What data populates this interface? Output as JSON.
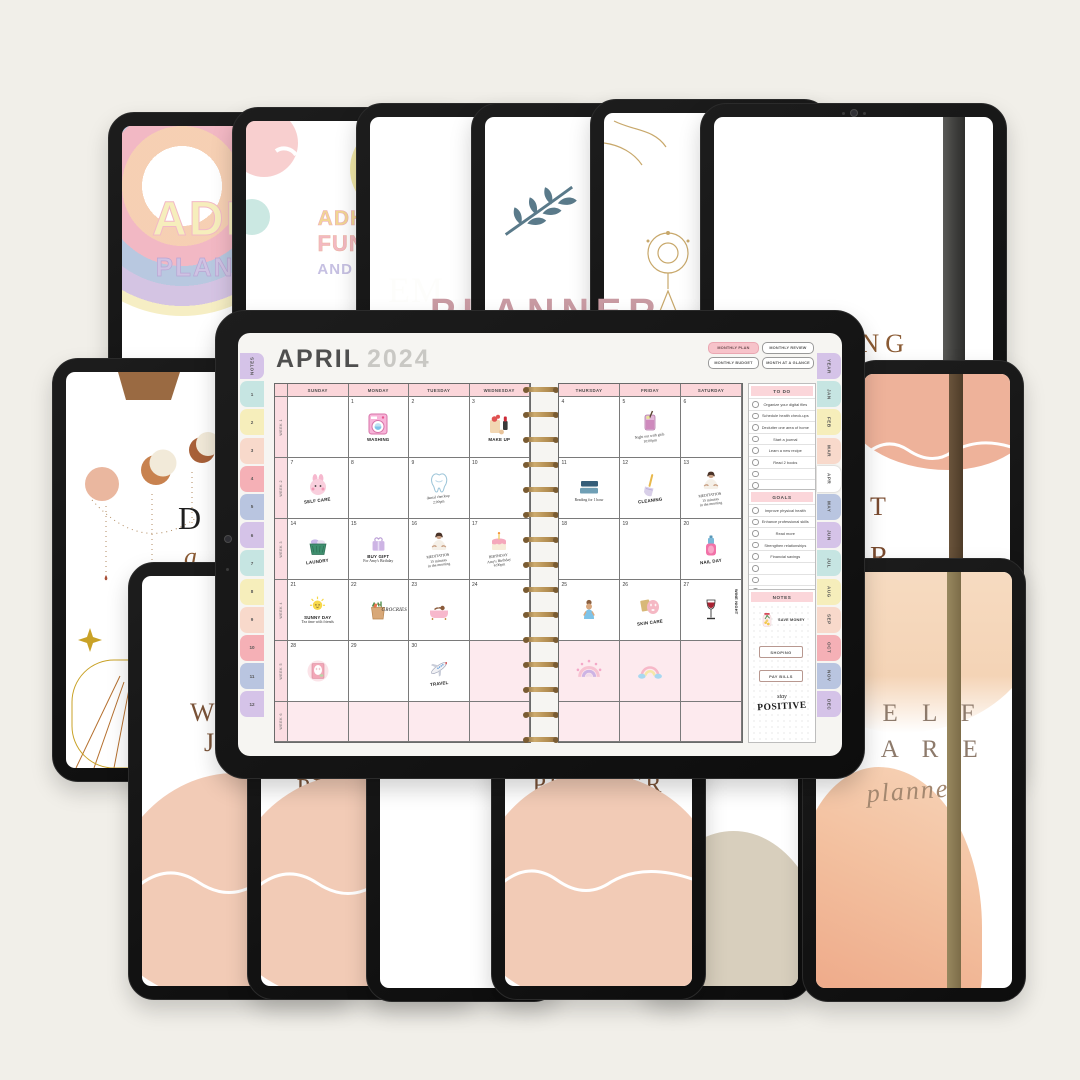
{
  "scene": {
    "background": "#f1efe9"
  },
  "covers": {
    "rainbow_planner": {
      "line1": "ADHD",
      "line2": "PLANNER"
    },
    "smiley_planner": {
      "line1": "ADHD",
      "line2": "FUNC",
      "line3": "AND CO"
    },
    "brown_monogram": {
      "text": "EM"
    },
    "reading_journal": {
      "line1": "READING",
      "line2": "JOURNAL"
    },
    "celestial": {
      "letter": "D",
      "script": "a"
    },
    "peach_strap": {
      "frag1": "T",
      "frag2": "R"
    },
    "hidden_top": {
      "fragment": "PLANNER"
    },
    "bottom_left_journal": {
      "frag1": "W",
      "frag2": "J"
    },
    "bottom_planner_fragment": {
      "text": "PLANNER"
    },
    "self_care": {
      "line1": "S E L F",
      "line2": "C A R E",
      "script": "planner"
    }
  },
  "planner": {
    "title_month": "APRIL",
    "title_year": "2024",
    "view_buttons": [
      {
        "label": "MONTHLY PLAN",
        "active": true
      },
      {
        "label": "MONTHLY REVIEW",
        "active": false
      },
      {
        "label": "MONTHLY BUDGET",
        "active": false
      },
      {
        "label": "MONTH AT A GLANCE",
        "active": false
      }
    ],
    "left_tabs": [
      "NOTES",
      "1",
      "2",
      "3",
      "4",
      "5",
      "6",
      "7",
      "8",
      "9",
      "10",
      "11",
      "12"
    ],
    "right_tabs": [
      "YEAR",
      "JAN",
      "FEB",
      "MAR",
      "APR",
      "MAY",
      "JUN",
      "JUL",
      "AUG",
      "SEP",
      "OCT",
      "NOV",
      "DEC"
    ],
    "active_right_tab": "APR",
    "week_labels": [
      "WEEK 1",
      "WEEK 2",
      "WEEK 3",
      "WEEK 4",
      "WEEK 5",
      "WEEK 6"
    ],
    "day_headers_left": [
      "SUNDAY",
      "MONDAY",
      "TUESDAY",
      "WEDNESDAY"
    ],
    "day_headers_right": [
      "THURSDAY",
      "FRIDAY",
      "SATURDAY"
    ],
    "weeks": [
      {
        "left": [
          {},
          {
            "d": "1",
            "s": "washing-machine",
            "l": "WASHING"
          },
          {
            "d": "2"
          },
          {
            "d": "3",
            "s": "makeup",
            "l": "MAKE UP"
          }
        ],
        "right": [
          {
            "d": "4"
          },
          {
            "d": "5",
            "s": "cocktail",
            "n": "Night out with girls\n10:00pm",
            "tilt": true
          },
          {
            "d": "6"
          }
        ]
      },
      {
        "left": [
          {
            "d": "7",
            "s": "bunny",
            "l": "SELF CARE",
            "tilt": true
          },
          {
            "d": "8"
          },
          {
            "d": "9",
            "s": "tooth",
            "n": "dental checkup\n2:00pm",
            "tilt": true
          },
          {
            "d": "10"
          }
        ],
        "right": [
          {
            "d": "11",
            "s": "books",
            "n": "Reading for 1 hour"
          },
          {
            "d": "12",
            "s": "broom",
            "l": "CLEANING",
            "tilt": true
          },
          {
            "d": "13",
            "s": "meditation",
            "n": "MEDITATION\n15 minutes\nin the morning",
            "tilt": true
          }
        ]
      },
      {
        "left": [
          {
            "d": "14",
            "s": "laundry-basket",
            "l": "LAUNDRY",
            "tilt": true
          },
          {
            "d": "15",
            "s": "gift",
            "l": "BUY GIFT",
            "n": "For Amy's Birthday"
          },
          {
            "d": "16",
            "s": "meditation",
            "n": "MEDITATION\n15 minutes\nin the morning",
            "tilt": true
          },
          {
            "d": "17",
            "s": "cake",
            "n": "BIRTHDAY\nAmy's Birthday\n6:00pm",
            "tilt": true
          }
        ],
        "right": [
          {
            "d": "18"
          },
          {
            "d": "19"
          },
          {
            "d": "20",
            "s": "nail-polish",
            "l": "NAIL DAY",
            "tilt": true
          }
        ]
      },
      {
        "left": [
          {
            "d": "21",
            "s": "sun",
            "l": "SUNNY DAY",
            "n": "Tea time with friends"
          },
          {
            "d": "22",
            "s": "groceries",
            "l": "GROCRIES",
            "side": true
          },
          {
            "d": "23",
            "s": "bathtub"
          },
          {
            "d": "24"
          }
        ],
        "right": [
          {
            "d": "25",
            "s": "woman"
          },
          {
            "d": "26",
            "s": "skincare",
            "l": "SKIN CARE",
            "tilt": true
          },
          {
            "d": "27",
            "s": "wine",
            "l": "WINE NIGHT",
            "vert": true
          }
        ]
      },
      {
        "left": [
          {
            "d": "28",
            "s": "face-mask"
          },
          {
            "d": "29"
          },
          {
            "d": "30",
            "s": "airplane",
            "l": "TRAVEL",
            "tilt": true
          },
          {
            "pink": true
          }
        ],
        "right": [
          {
            "pink": true,
            "s": "rainbow-hearts"
          },
          {
            "pink": true,
            "s": "rainbow-clouds"
          },
          {
            "pink": true
          }
        ]
      },
      {
        "left": [
          {
            "pink": true
          },
          {
            "pink": true
          },
          {
            "pink": true
          },
          {
            "pink": true
          }
        ],
        "right": [
          {
            "pink": true
          },
          {
            "pink": true
          },
          {
            "pink": true
          }
        ]
      }
    ],
    "todo": {
      "title": "TO DO",
      "items": [
        "Organize your digital files",
        "Schedule health check-ups",
        "Declutter one area of home",
        "Start a journal",
        "Learn a new recipe",
        "Read 2 books"
      ],
      "empty_rows": 2
    },
    "goals": {
      "title": "GOALS",
      "items": [
        "Improve physical health",
        "Enhance professional skills",
        "Read more",
        "Strengthen relationships",
        "Financial savings"
      ],
      "empty_rows": 3
    },
    "notes": {
      "title": "NOTES",
      "sticker": "savings-jar",
      "sticker_label": "SAVE MONEY",
      "ribbon1": "SHOPING",
      "ribbon2": "PAY BILLS",
      "script1": "stay",
      "script2": "POSITIVE"
    },
    "colors": {
      "accent_pink": "#fbd6da",
      "cell_pink": "#fdeaee",
      "gold_coil": "#b08a4f",
      "tab_palette": [
        "#d5c3e8",
        "#c6e5e2",
        "#f6eebb",
        "#f8d9cb",
        "#f5b0b6",
        "#b9c5e0"
      ]
    }
  }
}
